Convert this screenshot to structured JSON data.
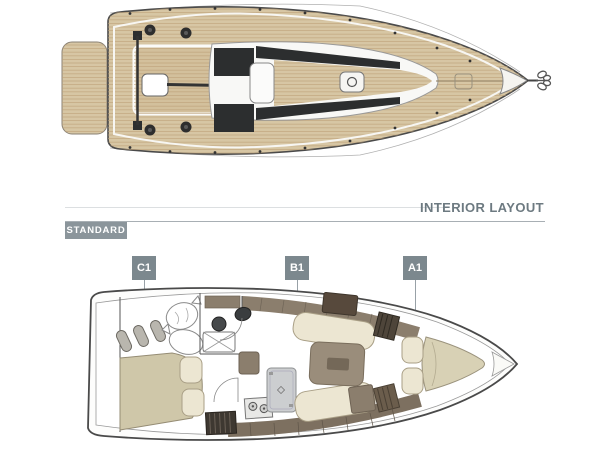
{
  "header": {
    "section_title": "INTERIOR LAYOUT",
    "variant_label": "STANDARD"
  },
  "markers": [
    {
      "label": "C1"
    },
    {
      "label": "B1"
    },
    {
      "label": "A1"
    }
  ],
  "deck_plan": {
    "id": "deck-plan",
    "features": [
      "swim-platform",
      "stern-cockpit",
      "mainsheet-traveler",
      "tiller",
      "winches",
      "companionway-hatch",
      "coachroof-windows",
      "foredeck-hatch",
      "bow-anchor",
      "lifelines"
    ]
  },
  "interior_plan": {
    "id": "interior-layout-plan",
    "variant": "STANDARD",
    "sections": [
      "C1",
      "B1",
      "A1"
    ],
    "features": [
      "aft-cabin-berth",
      "fenders",
      "sail-bags",
      "head-with-shower",
      "companionway-steps",
      "galley-stove",
      "fridge-unit",
      "salon-table",
      "settees",
      "wardrobes",
      "v-berth",
      "bow-locker"
    ]
  },
  "colors": {
    "teak": "#d7c6a4",
    "plank_line": "#bb9f77",
    "dark_glass": "#2c2e2f",
    "cream_cushion": "#ece6d2",
    "khaki_berth": "#cfc7a9",
    "taupe_furniture": "#8b7e6d",
    "dark_wood": "#4e453a",
    "marker_background": "#7c888e",
    "variant_background": "#8b959b",
    "title_text": "#6d7a81"
  }
}
